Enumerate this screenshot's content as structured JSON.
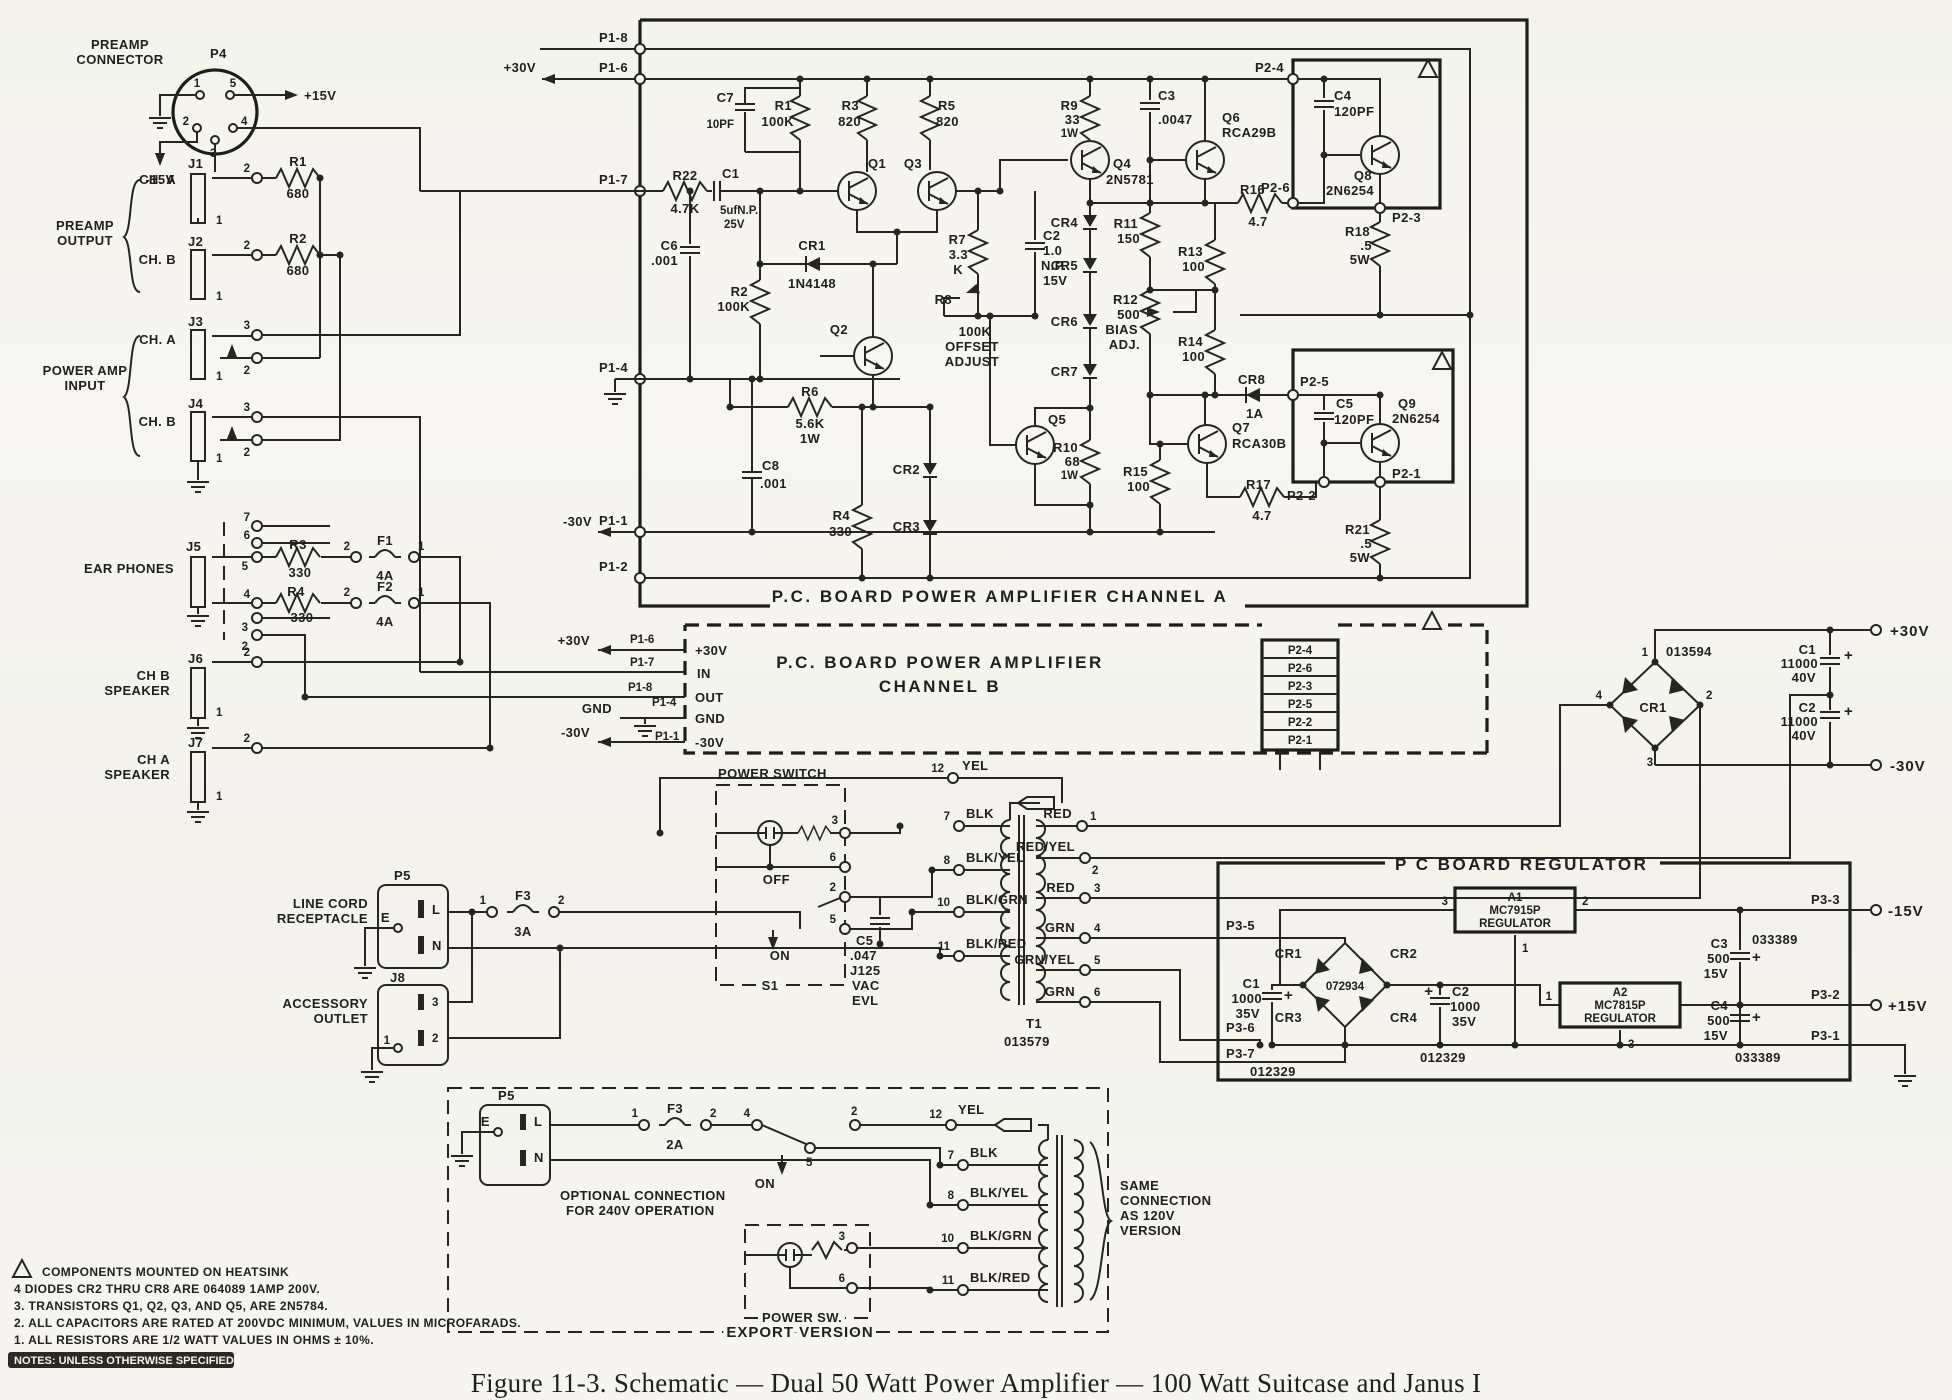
{
  "caption": "Figure 11-3.  Schematic — Dual 50 Watt Power Amplifier — 100 Watt Suitcase and Janus I",
  "num": {
    "1": "1",
    "2": "2",
    "3": "3",
    "4": "4",
    "5": "5",
    "6": "6",
    "7": "7",
    "8": "8",
    "10": "10",
    "11": "11",
    "12": "12"
  },
  "wire": {
    "yel": "YEL",
    "blk": "BLK",
    "blk_yel": "BLK/YEL",
    "blk_grn": "BLK/GRN",
    "blk_red": "BLK/RED",
    "red": "RED",
    "red_yel": "RED/YEL",
    "grn": "GRN",
    "grn_yel": "GRN/YEL"
  },
  "preamp": {
    "t1": "PREAMP",
    "t2": "CONNECTOR",
    "p4": "P4",
    "v15p": "+15V",
    "v15n": "-15V",
    "out1": "PREAMP",
    "out2": "OUTPUT",
    "in1": "POWER AMP",
    "in2": "INPUT",
    "j1": "J1",
    "j1c": "CH. A",
    "j2": "J2",
    "j2c": "CH. B",
    "j3": "J3",
    "j3c": "CH. A",
    "j4": "J4",
    "j4c": "CH. B",
    "j5": "J5",
    "j5c": "EAR PHONES",
    "j6": "J6",
    "j6c1": "CH B",
    "j6c2": "SPEAKER",
    "j7": "J7",
    "j7c1": "CH A",
    "j7c2": "SPEAKER",
    "r1": "R1",
    "r1v": "680",
    "r2": "R2",
    "r2v": "680",
    "r3": "R3",
    "r3v": "330",
    "r4": "R4",
    "r4v": "330",
    "f1": "F1",
    "f1v": "4A",
    "f2": "F2",
    "f2v": "4A"
  },
  "ca": {
    "title": "P.C.  BOARD  POWER  AMPLIFIER  CHANNEL  A",
    "p1_8": "P1-8",
    "p1_6": "P1-6",
    "p1_7": "P1-7",
    "p1_4": "P1-4",
    "p1_1": "P1-1",
    "p1_2": "P1-2",
    "v30p": "+30V",
    "v30n": "-30V",
    "c7": "C7",
    "c7v": "10PF",
    "r1": "R1",
    "r1v": "100K",
    "r3": "R3",
    "r3v": "820",
    "r5": "R5",
    "r5v": "820",
    "q1": "Q1",
    "q3": "Q3",
    "r22": "R22",
    "r22v": "4.7K",
    "c1": "C1",
    "c1v": "5ufN.P.",
    "c1r": "25V",
    "c6": "C6",
    "c6v": ".001",
    "r2": "R2",
    "r2v": "100K",
    "cr1": "CR1",
    "cr1v": "1N4148",
    "r7": "R7",
    "r7v": "3.3",
    "r7v2": "K",
    "c2": "C2",
    "c2v": "1.0",
    "c2v2": "N.P.",
    "c2r": "15V",
    "r8": "R8",
    "r8v": "100K",
    "r8l1": "OFFSET",
    "r8l2": "ADJUST",
    "q2": "Q2",
    "r6": "R6",
    "r6v": "5.6K",
    "r6w": "1W",
    "c8": "C8",
    "c8v": ".001",
    "cr2": "CR2",
    "cr3": "CR3",
    "r4": "R4",
    "r4v": "330",
    "r9": "R9",
    "r9v": "33",
    "r9w": "1W",
    "c3": "C3",
    "c3v": ".0047",
    "q4": "Q4",
    "q4v": "2N5781",
    "cr4": "CR4",
    "cr5": "CR5",
    "cr6": "CR6",
    "cr7": "CR7",
    "r10": "R10",
    "r10v": "68",
    "r10w": "1W",
    "r11": "R11",
    "r11v": "150",
    "r12": "R12",
    "r12v": "500",
    "r12l1": "BIAS",
    "r12l2": "ADJ.",
    "r13": "R13",
    "r13v": "100",
    "r14": "R14",
    "r14v": "100",
    "r15": "R15",
    "r15v": "100",
    "q5": "Q5",
    "q6": "Q6",
    "q6v": "RCA29B",
    "q7": "Q7",
    "q7v": "RCA30B",
    "r16": "R16",
    "r16v": "4.7",
    "r17": "R17",
    "r17v": "4.7",
    "p2_6": "P2-6",
    "p2_4": "P2-4",
    "p2_3": "P2-3",
    "p2_5": "P2-5",
    "p2_2": "P2-2",
    "p2_1": "P2-1",
    "c4": "C4",
    "c4v": "120PF",
    "c5": "C5",
    "c5v": "120PF",
    "q8": "Q8",
    "q8v": "2N6254",
    "q9": "Q9",
    "q9v": "2N6254",
    "r18": "R18",
    "r18v": ".5",
    "r18w": "5W",
    "r21": "R21",
    "r21v": ".5",
    "r21w": "5W",
    "cr8": "CR8",
    "cr8v": "1A"
  },
  "cb": {
    "t1": "P.C.  BOARD  POWER  AMPLIFIER",
    "t2": "CHANNEL  B",
    "v30p": "+30V",
    "v30n": "-30V",
    "gnd": "GND",
    "p1_6": "P1-6",
    "p1_7": "P1-7",
    "p1_8": "P1-8",
    "p1_4": "P1-4",
    "p1_1": "P1-1",
    "in_v30p": "+30V",
    "in_in": "IN",
    "in_out": "OUT",
    "in_gnd": "GND",
    "in_v30n": "-30V",
    "s0": "P2-4",
    "s1": "P2-6",
    "s2": "P2-3",
    "s3": "P2-5",
    "s4": "P2-2",
    "s5": "P2-1"
  },
  "ps": {
    "cr1": "CR1",
    "part": "013594",
    "c1": "C1",
    "c1v": "11000",
    "c1r": "40V",
    "c2": "C2",
    "c2v": "11000",
    "c2r": "40V",
    "v30p": "+30V",
    "v30n": "-30V",
    "plus": "+"
  },
  "lc": {
    "p5": "P5",
    "l": "L",
    "n": "N",
    "e": "E",
    "t1": "LINE CORD",
    "t2": "RECEPTACLE",
    "f3": "F3",
    "f3v": "3A",
    "j8": "J8",
    "a1": "ACCESSORY",
    "a2": "OUTLET"
  },
  "sw": {
    "title": "POWER SWITCH",
    "off": "OFF",
    "on": "ON",
    "s1": "S1",
    "c5": "C5",
    "c5v": ".047",
    "c5v2": "J125",
    "c5v3": "VAC",
    "c5v4": "EVL"
  },
  "tr": {
    "t1": "T1",
    "part": "013579"
  },
  "rg": {
    "title": "P C  BOARD  REGULATOR",
    "p3_5": "P3-5",
    "p3_6": "P3-6",
    "p3_7": "P3-7",
    "p3_3": "P3-3",
    "p3_2": "P3-2",
    "p3_1": "P3-1",
    "a1": "A1",
    "a1v": "MC7915P",
    "a1l": "REGULATOR",
    "a2": "A2",
    "a2v": "MC7815P",
    "a2l": "REGULATOR",
    "cr1": "CR1",
    "cr2": "CR2",
    "cr3": "CR3",
    "cr4": "CR4",
    "part": "072934",
    "c1": "C1",
    "c1v": "1000",
    "c1r": "35V",
    "c1p": "012329",
    "c2": "C2",
    "c2v": "1000",
    "c2r": "35V",
    "c2p": "012329",
    "c3": "C3",
    "c3v": "500",
    "c3r": "15V",
    "c3p": "033389",
    "c4": "C4",
    "c4v": "500",
    "c4r": "15V",
    "c4p": "033389",
    "v15n": "-15V",
    "v15p": "+15V",
    "plus": "+"
  },
  "ex": {
    "title": "EXPORT  VERSION",
    "p5": "P5",
    "e": "E",
    "l": "L",
    "n": "N",
    "f3": "F3",
    "f3v": "2A",
    "on": "ON",
    "opt1": "OPTIONAL CONNECTION",
    "opt2": "FOR 240V OPERATION",
    "psw": "POWER SW.",
    "s1": "SAME",
    "s2": "CONNECTION",
    "s3": "AS 120V",
    "s4": "VERSION"
  },
  "notes": {
    "hs": "COMPONENTS MOUNTED ON HEATSINK",
    "n4": "4   DIODES CR2 THRU CR8 ARE 064089  1AMP 200V.",
    "n3": "3.  TRANSISTORS Q1, Q2, Q3, AND Q5, ARE 2N5784.",
    "n2": "2.  ALL CAPACITORS ARE RATED AT 200VDC MINIMUM, VALUES IN MICROFARADS.",
    "n1": "1.  ALL RESISTORS ARE 1/2 WATT VALUES IN OHMS ± 10%.",
    "hdr": "NOTES: UNLESS OTHERWISE SPECIFIED"
  }
}
